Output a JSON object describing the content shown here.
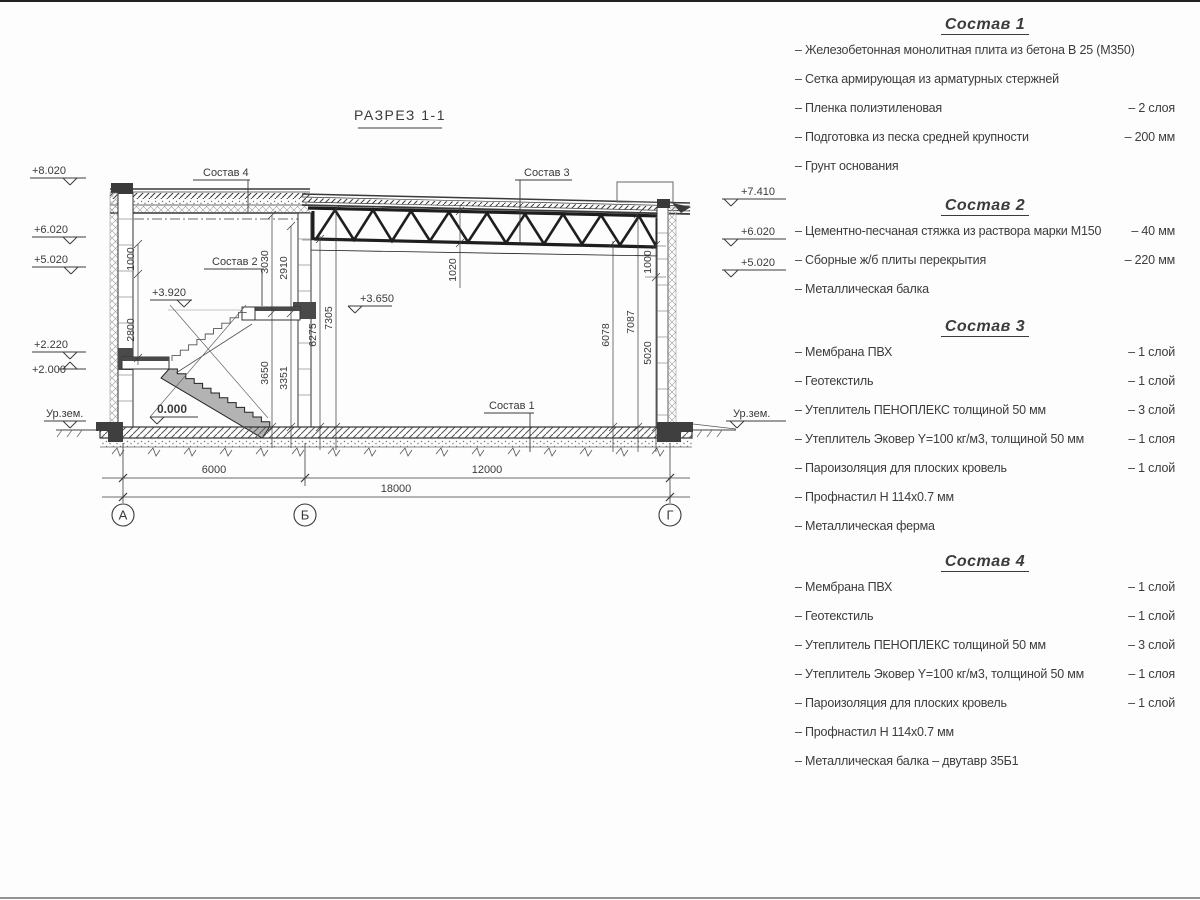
{
  "page": {
    "title": "РАЗРЕЗ 1-1"
  },
  "drawing": {
    "axes": [
      "А",
      "Б",
      "Г"
    ],
    "dims_bottom": [
      "6000",
      "12000",
      "18000"
    ],
    "elev_left": [
      "+8.020",
      "+6.020",
      "+5.020",
      "+2.220",
      "+2.000",
      "Ур.зем."
    ],
    "elev_right": [
      "+7.410",
      "+6.020",
      "+5.020",
      "Ур.зем."
    ],
    "elev_inner": [
      "+3.920",
      "+3.650",
      "0.000"
    ],
    "vdims": {
      "v1000l": "1000",
      "v2800": "2800",
      "v3030": "3030",
      "v2910": "2910",
      "v3650": "3650",
      "v3351": "3351",
      "v6275": "6275",
      "v7305": "7305",
      "v1020": "1020",
      "v6078": "6078",
      "v7087": "7087",
      "v5020": "5020",
      "v1000r": "1000"
    },
    "callouts": [
      "Состав 4",
      "Состав 3",
      "Состав 2",
      "Состав 1"
    ]
  },
  "specs": {
    "sections": [
      {
        "heading": "Состав 1",
        "items": [
          {
            "label": "– Железобетонная  монолитная плита из бетона В 25 (М350)",
            "value": ""
          },
          {
            "label": "– Сетка армирующая из арматурных стержней",
            "value": ""
          },
          {
            "label": "– Пленка полиэтиленовая",
            "value": "– 2 слоя"
          },
          {
            "label": "– Подготовка из песка средней крупности",
            "value": "– 200 мм"
          },
          {
            "label": "– Грунт основания",
            "value": ""
          }
        ]
      },
      {
        "heading": "Состав 2",
        "items": [
          {
            "label": "– Цементно-песчаная стяжка из раствора марки М150",
            "value": "– 40 мм"
          },
          {
            "label": "– Сборные ж/б плиты перекрытия",
            "value": "– 220 мм"
          },
          {
            "label": "– Металлическая балка",
            "value": ""
          }
        ]
      },
      {
        "heading": "Состав 3",
        "items": [
          {
            "label": "– Мембрана ПВХ",
            "value": "– 1 слой"
          },
          {
            "label": "– Геотекстиль",
            "value": "– 1 слой"
          },
          {
            "label": "– Утеплитель ПЕНОПЛЕКС толщиной 50 мм",
            "value": "– 3 слой"
          },
          {
            "label": "– Утеплитель Эковер Y=100 кг/м3, толщиной 50 мм",
            "value": "– 1 слоя"
          },
          {
            "label": "– Пароизоляция для плоских кровель",
            "value": "– 1 слой"
          },
          {
            "label": "– Профнастил Н 114х0.7 мм",
            "value": ""
          },
          {
            "label": "– Металлическая ферма",
            "value": ""
          }
        ]
      },
      {
        "heading": "Состав 4",
        "items": [
          {
            "label": "– Мембрана ПВХ",
            "value": "– 1 слой"
          },
          {
            "label": "– Геотекстиль",
            "value": "– 1 слой"
          },
          {
            "label": "– Утеплитель ПЕНОПЛЕКС толщиной 50 мм",
            "value": "– 3 слой"
          },
          {
            "label": "– Утеплитель Эковер Y=100 кг/м3, толщиной 50 мм",
            "value": "– 1 слоя"
          },
          {
            "label": "– Пароизоляция для плоских кровель",
            "value": "– 1 слой"
          },
          {
            "label": "– Профнастил Н 114х0.7 мм",
            "value": ""
          },
          {
            "label": "– Металлическая балка – двутавр 35Б1",
            "value": ""
          }
        ]
      }
    ]
  }
}
